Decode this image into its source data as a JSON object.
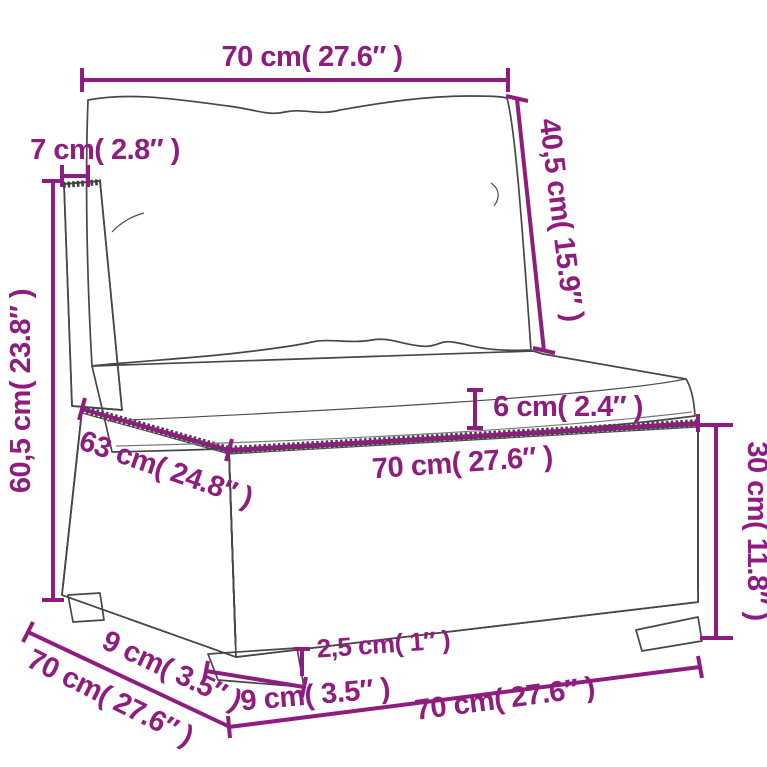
{
  "diagram": {
    "subject": "poly-rattan-sofa-section-dimension-diagram",
    "dimensions": {
      "back_width": "70 cm( 27.6″ )",
      "back_frame_depth": "7 cm( 2.8″ )",
      "back_cushion_length": "40,5 cm( 15.9″ )",
      "back_height": "60,5 cm( 23.8″ )",
      "seat_cushion_thickness": "6 cm( 2.4″ )",
      "seat_depth": "63 cm( 24.8″ )",
      "seat_width": "70 cm( 27.6″ )",
      "base_height": "30 cm( 11.8″ )",
      "leg_height": "2,5 cm( 1″ )",
      "front_leg_width": "9 cm( 3.5″ )",
      "side_leg_width": "9 cm( 3.5″ )",
      "overall_width": "70 cm( 27.6″ )",
      "overall_depth": "70 cm( 27.6″ )"
    },
    "colors": {
      "annotation": "#8e1d7f",
      "line_art": "#474747",
      "background": "#ffffff"
    }
  }
}
